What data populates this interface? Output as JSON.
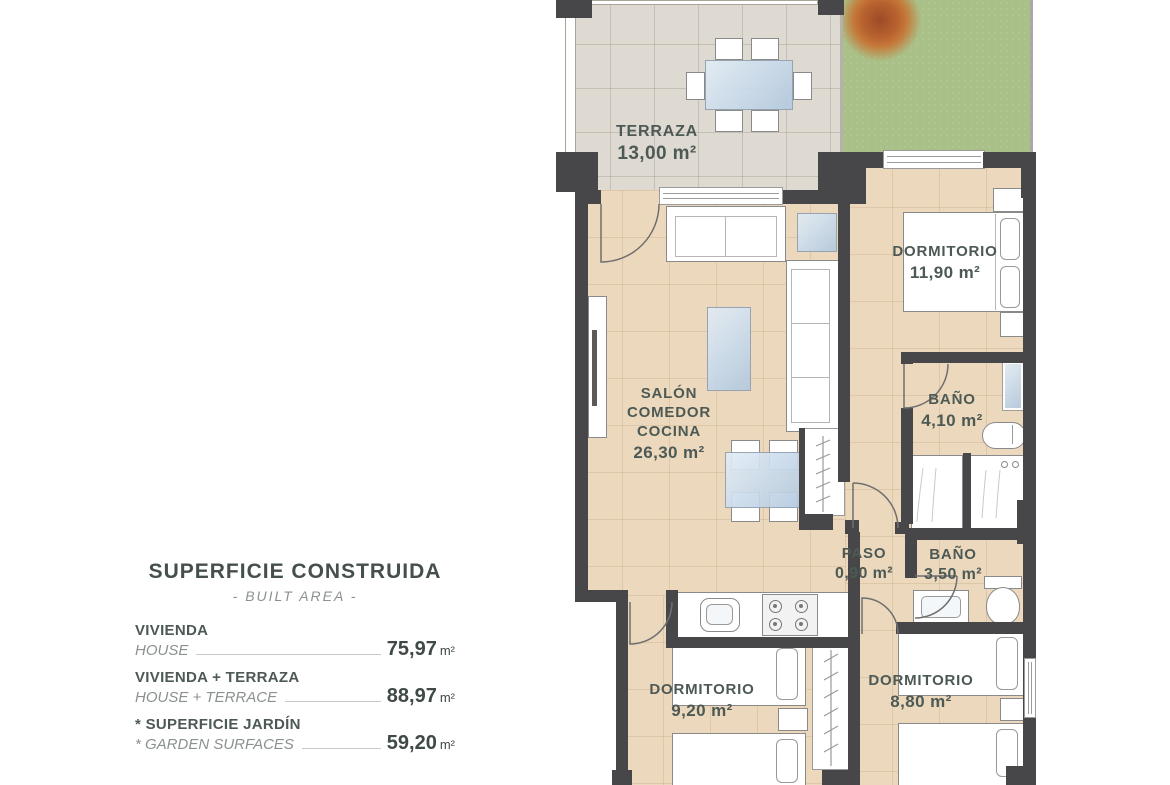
{
  "colors": {
    "floor": "#ecd9bd",
    "terrace": "#dedad2",
    "garden": "#a9c189",
    "wall": "#474749",
    "ink": "#4d5955",
    "muted": "#8a918e",
    "leader": "#c9c9c9",
    "glass_light": "#e3edf4",
    "glass_dark": "#b3c9de"
  },
  "legend": {
    "title": "SUPERFICIE CONSTRUIDA",
    "subtitle": "- BUILT AREA -",
    "rows": [
      {
        "label": "VIVIENDA",
        "label_en": "HOUSE",
        "value": "75,97",
        "unit": "m²"
      },
      {
        "label": "VIVIENDA + TERRAZA",
        "label_en": "HOUSE + TERRACE",
        "value": "88,97",
        "unit": "m²"
      },
      {
        "label": "* SUPERFICIE JARDÍN",
        "label_en": "* GARDEN SURFACES",
        "value": "59,20",
        "unit": "m²"
      }
    ]
  },
  "rooms": {
    "terraza": {
      "name": "TERRAZA",
      "area": "13,00 m²"
    },
    "dormitorio_1": {
      "name": "DORMITORIO",
      "area": "11,90 m²"
    },
    "salon": {
      "name_line1": "SALÓN",
      "name_line2": "COMEDOR",
      "name_line3": "COCINA",
      "area": "26,30 m²"
    },
    "bano_1": {
      "name": "BAÑO",
      "area": "4,10 m²"
    },
    "paso": {
      "name": "PASO",
      "area": "0,90 m²"
    },
    "bano_2": {
      "name": "BAÑO",
      "area": "3,50 m²"
    },
    "dormitorio_2": {
      "name": "DORMITORIO",
      "area": "9,20 m²"
    },
    "dormitorio_3": {
      "name": "DORMITORIO",
      "area": "8,80 m²"
    }
  }
}
